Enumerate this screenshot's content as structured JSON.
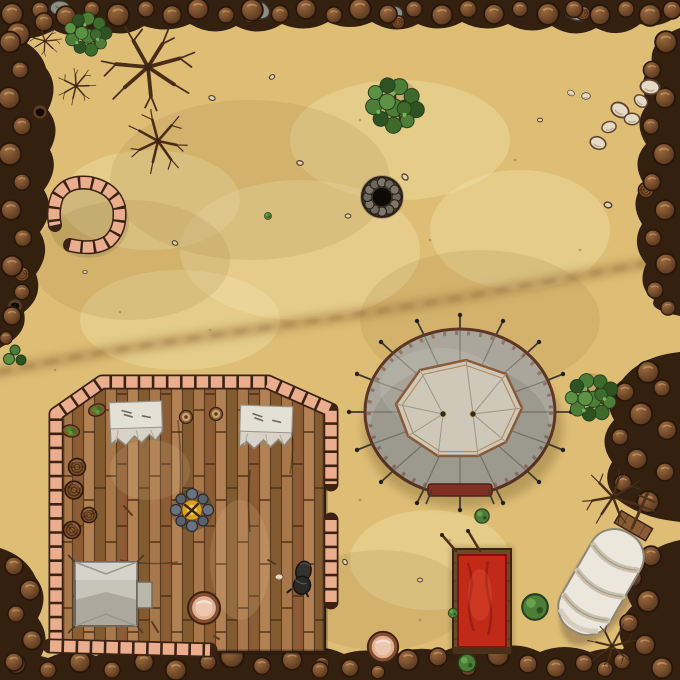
{
  "map": {
    "width": 680,
    "height": 680,
    "scene": "desert camp battle map"
  },
  "colors": {
    "sand": "#debe75",
    "sand_light": "#efd9a0",
    "sand_dark": "#c4a05c",
    "trail": "#a8824a",
    "rock_dark": "#33200f",
    "rock_mid": "#6e452a",
    "rock_light": "#936744",
    "brick": "#eaae8e",
    "brick_dark": "#3c2212",
    "wood": "#9a6c42",
    "wood_dark": "#5a3a1e",
    "canvas": "#aaa69b",
    "canvas_light": "#cdc8b7",
    "trim_brown": "#5e3626",
    "red": "#c22a18",
    "red_dark": "#7e150c",
    "leaf": "#4d7d37",
    "leaf_dark": "#2e5222",
    "branch": "#4a2d17",
    "fire": "#d9a31f",
    "stone_blue": "#656d78",
    "pot": "#e0b193",
    "pot_dark": "#8a5030",
    "white_stone": "#e6dac4",
    "well_dark": "#0d0a07"
  },
  "objects": {
    "trail": {
      "d": "M0,372 C110,348 240,332 352,315 C450,301 560,279 648,263"
    },
    "stone_pen": {
      "transform": "translate(87,216)"
    },
    "well": {
      "transform": "translate(382,197)"
    },
    "building": {
      "transform": "translate(0,0)"
    },
    "camp_fire": {
      "transform": "translate(192,510)"
    },
    "small_tent": {
      "transform": "translate(106,594)"
    },
    "table_1": {
      "transform": "translate(136,422) rotate(-2)"
    },
    "table_2": {
      "transform": "translate(266,426) rotate(2)"
    },
    "black_bag": {
      "transform": "translate(302,577) rotate(14)"
    },
    "pavilion": {
      "transform": "translate(460,412)"
    },
    "red_tent": {
      "transform": "translate(482,601)"
    },
    "wagon": {
      "transform": "translate(601,582) rotate(30)"
    }
  },
  "terrain_instances": [
    [
      "rock-gray",
      "gray-slab",
      258,
      10,
      1.1,
      20
    ],
    [
      "rock-gray",
      "gray-slab",
      392,
      14,
      1.0,
      -10
    ],
    [
      "rock-gray",
      "gray-slab",
      577,
      12,
      1.1,
      15
    ],
    [
      "rock-gray",
      "gray-slab",
      60,
      8,
      0.9,
      0
    ],
    [
      "barrel",
      "rock-barrel",
      250,
      16,
      0.8
    ],
    [
      "barrel",
      "rock-barrel",
      398,
      22,
      0.75
    ],
    [
      "barrel",
      "rock-barrel",
      118,
      9,
      0.7
    ],
    [
      "barrel",
      "rock-barrel",
      583,
      13,
      0.8
    ],
    [
      "barrel",
      "rock-barrel",
      646,
      190,
      0.9
    ],
    [
      "barrel",
      "rock-barrel",
      652,
      560,
      0.8
    ],
    [
      "barrel",
      "rock-barrel",
      322,
      664,
      0.8
    ],
    [
      "barrel",
      "rock-barrel",
      22,
      274,
      0.85
    ],
    [
      "dark-hole",
      "rock-hole",
      40,
      112,
      1
    ],
    [
      "dark-hole",
      "rock-hole",
      15,
      306,
      1
    ],
    [
      "boulder-brown",
      "rock-boulder",
      12,
      14,
      1.2
    ],
    [
      "boulder-brown",
      "rock-boulder",
      40,
      10,
      0.9
    ],
    [
      "boulder-brown",
      "rock-boulder",
      66,
      16,
      1.1
    ],
    [
      "boulder-brown",
      "rock-boulder",
      92,
      9,
      0.85
    ],
    [
      "boulder-brown",
      "rock-boulder",
      118,
      15,
      1.25
    ],
    [
      "boulder-brown",
      "rock-boulder",
      146,
      9,
      0.9
    ],
    [
      "boulder-brown",
      "rock-boulder",
      172,
      15,
      1.05
    ],
    [
      "boulder-brown",
      "rock-boulder",
      198,
      9,
      1.15
    ],
    [
      "boulder-brown",
      "rock-boulder",
      226,
      15,
      0.9
    ],
    [
      "boulder-brown",
      "rock-boulder",
      252,
      10,
      1.2
    ],
    [
      "boulder-brown",
      "rock-boulder",
      280,
      14,
      0.95
    ],
    [
      "boulder-brown",
      "rock-boulder",
      306,
      9,
      1.1
    ],
    [
      "boulder-brown",
      "rock-boulder",
      334,
      15,
      0.9
    ],
    [
      "boulder-brown",
      "rock-boulder",
      360,
      9,
      1.2
    ],
    [
      "boulder-brown",
      "rock-boulder",
      388,
      14,
      1.0
    ],
    [
      "boulder-brown",
      "rock-boulder",
      414,
      9,
      0.9
    ],
    [
      "boulder-brown",
      "rock-boulder",
      442,
      15,
      1.15
    ],
    [
      "boulder-brown",
      "rock-boulder",
      468,
      9,
      0.95
    ],
    [
      "boulder-brown",
      "rock-boulder",
      494,
      14,
      1.1
    ],
    [
      "boulder-brown",
      "rock-boulder",
      520,
      9,
      0.85
    ],
    [
      "boulder-brown",
      "rock-boulder",
      548,
      14,
      1.2
    ],
    [
      "boulder-brown",
      "rock-boulder",
      574,
      9,
      0.95
    ],
    [
      "boulder-brown",
      "rock-boulder",
      600,
      15,
      1.1
    ],
    [
      "boulder-brown",
      "rock-boulder",
      626,
      9,
      0.9
    ],
    [
      "boulder-brown",
      "rock-boulder",
      650,
      15,
      1.2
    ],
    [
      "boulder-brown",
      "rock-boulder",
      672,
      10,
      1.0
    ],
    [
      "boulder-brown",
      "rock-boulder",
      18,
      34,
      1.3
    ],
    [
      "boulder-brown",
      "rock-boulder",
      44,
      22,
      1.0
    ],
    [
      "boulder-brown",
      "rock-boulder",
      10,
      42,
      1.15
    ],
    [
      "boulder-brown",
      "rock-boulder",
      20,
      70,
      0.9
    ],
    [
      "boulder-brown",
      "rock-boulder",
      9,
      98,
      1.2
    ],
    [
      "boulder-brown",
      "rock-boulder",
      22,
      126,
      1.0
    ],
    [
      "boulder-brown",
      "rock-boulder",
      10,
      154,
      1.25
    ],
    [
      "boulder-brown",
      "rock-boulder",
      22,
      182,
      0.9
    ],
    [
      "boulder-brown",
      "rock-boulder",
      11,
      210,
      1.1
    ],
    [
      "boulder-brown",
      "rock-boulder",
      23,
      238,
      0.95
    ],
    [
      "boulder-brown",
      "rock-boulder",
      12,
      266,
      1.15
    ],
    [
      "boulder-brown",
      "rock-boulder",
      22,
      292,
      0.85
    ],
    [
      "boulder-brown",
      "rock-boulder",
      12,
      316,
      1.0
    ],
    [
      "boulder-brown",
      "rock-boulder",
      6,
      338,
      0.7
    ],
    [
      "boulder-brown",
      "rock-boulder",
      666,
      42,
      1.2
    ],
    [
      "boulder-brown",
      "rock-boulder",
      652,
      70,
      0.95
    ],
    [
      "boulder-brown",
      "rock-boulder",
      665,
      98,
      1.1
    ],
    [
      "boulder-brown",
      "rock-boulder",
      651,
      126,
      0.9
    ],
    [
      "boulder-brown",
      "rock-boulder",
      664,
      154,
      1.2
    ],
    [
      "boulder-brown",
      "rock-boulder",
      652,
      182,
      0.95
    ],
    [
      "boulder-brown",
      "rock-boulder",
      665,
      210,
      1.1
    ],
    [
      "boulder-brown",
      "rock-boulder",
      653,
      238,
      0.9
    ],
    [
      "boulder-brown",
      "rock-boulder",
      666,
      264,
      1.15
    ],
    [
      "boulder-brown",
      "rock-boulder",
      655,
      290,
      0.9
    ],
    [
      "boulder-brown",
      "rock-boulder",
      668,
      308,
      0.8
    ],
    [
      "boulder-brown",
      "rock-boulder",
      648,
      372,
      1.2
    ],
    [
      "boulder-brown",
      "rock-boulder",
      625,
      392,
      1.0
    ],
    [
      "boulder-brown",
      "rock-boulder",
      641,
      414,
      1.25
    ],
    [
      "boulder-brown",
      "rock-boulder",
      620,
      437,
      0.9
    ],
    [
      "boulder-brown",
      "rock-boulder",
      637,
      459,
      1.1
    ],
    [
      "boulder-brown",
      "rock-boulder",
      623,
      483,
      0.95
    ],
    [
      "boulder-brown",
      "rock-boulder",
      648,
      502,
      1.2
    ],
    [
      "boulder-brown",
      "rock-boulder",
      667,
      430,
      1.05
    ],
    [
      "boulder-brown",
      "rock-boulder",
      662,
      388,
      0.9
    ],
    [
      "boulder-brown",
      "rock-boulder",
      665,
      472,
      1.0
    ],
    [
      "boulder-brown",
      "rock-boulder",
      651,
      556,
      1.1
    ],
    [
      "boulder-brown",
      "rock-boulder",
      633,
      578,
      0.95
    ],
    [
      "boulder-brown",
      "rock-boulder",
      648,
      601,
      1.2
    ],
    [
      "boulder-brown",
      "rock-boulder",
      629,
      623,
      1.0
    ],
    [
      "boulder-brown",
      "rock-boulder",
      645,
      645,
      1.1
    ],
    [
      "boulder-brown",
      "rock-boulder",
      622,
      661,
      0.9
    ],
    [
      "boulder-brown",
      "rock-boulder",
      662,
      668,
      1.15
    ],
    [
      "boulder-brown",
      "rock-boulder",
      605,
      669,
      0.85
    ],
    [
      "boulder-brown",
      "rock-boulder",
      16,
      664,
      1.05
    ],
    [
      "boulder-brown",
      "rock-boulder",
      48,
      670,
      0.9
    ],
    [
      "boulder-brown",
      "rock-boulder",
      80,
      662,
      1.15
    ],
    [
      "boulder-brown",
      "rock-boulder",
      112,
      670,
      0.9
    ],
    [
      "boulder-brown",
      "rock-boulder",
      144,
      662,
      1.05
    ],
    [
      "boulder-brown",
      "rock-boulder",
      176,
      670,
      1.15
    ],
    [
      "boulder-brown",
      "rock-boulder",
      208,
      662,
      0.9
    ],
    [
      "boulder-brown",
      "rock-boulder",
      232,
      656,
      1.3
    ],
    [
      "boulder-brown",
      "rock-boulder",
      262,
      666,
      0.95
    ],
    [
      "boulder-brown",
      "rock-boulder",
      292,
      660,
      1.1
    ],
    [
      "boulder-brown",
      "rock-boulder",
      320,
      670,
      0.9
    ],
    [
      "boulder-brown",
      "rock-boulder",
      350,
      668,
      0.95
    ],
    [
      "boulder-brown",
      "rock-boulder",
      378,
      672,
      0.75
    ],
    [
      "boulder-brown",
      "rock-boulder",
      408,
      660,
      1.15
    ],
    [
      "boulder-brown",
      "rock-boulder",
      438,
      657,
      1.0
    ],
    [
      "boulder-brown",
      "rock-boulder",
      468,
      668,
      0.85
    ],
    [
      "boulder-brown",
      "rock-boulder",
      498,
      655,
      1.2
    ],
    [
      "boulder-brown",
      "rock-boulder",
      528,
      664,
      1.0
    ],
    [
      "boulder-brown",
      "rock-boulder",
      556,
      668,
      1.05
    ],
    [
      "boulder-brown",
      "rock-boulder",
      584,
      663,
      0.95
    ],
    [
      "boulder-brown",
      "rock-boulder",
      14,
      566,
      1.0
    ],
    [
      "boulder-brown",
      "rock-boulder",
      30,
      590,
      1.1
    ],
    [
      "boulder-brown",
      "rock-boulder",
      16,
      614,
      0.9
    ],
    [
      "boulder-brown",
      "rock-boulder",
      32,
      640,
      1.05
    ],
    [
      "boulder-brown",
      "rock-boulder",
      14,
      662,
      1.0
    ]
  ],
  "object_instances": [
    [
      "tree-green",
      "green-tree",
      88,
      33,
      0.8,
      0,
      true
    ],
    [
      "tree-green",
      "green-tree",
      395,
      104,
      1.0,
      15,
      true
    ],
    [
      "tree-green",
      "green-tree",
      592,
      396,
      0.9,
      -20,
      true
    ],
    [
      "scrub-tree",
      "dead-scrub",
      45,
      41,
      0.5,
      10,
      true
    ],
    [
      "scrub-tree",
      "dead-scrub",
      76,
      86,
      0.6,
      -35,
      true
    ],
    [
      "scrub-tree",
      "dead-scrub",
      148,
      67,
      1.45,
      0,
      true
    ],
    [
      "scrub-tree",
      "dead-scrub",
      158,
      141,
      1.0,
      70,
      true
    ],
    [
      "scrub-tree",
      "dead-scrub",
      613,
      497,
      0.95,
      -15,
      true
    ],
    [
      "scrub-tree",
      "dead-scrub",
      612,
      646,
      0.75,
      160,
      true
    ],
    [
      "ball-bush",
      "small-bush",
      482,
      516,
      0.9,
      0,
      true
    ],
    [
      "ball-bush",
      "small-bush",
      453,
      613,
      0.6,
      0,
      true
    ],
    [
      "ball-bush",
      "small-bush",
      467,
      663,
      1.1,
      0,
      true
    ],
    [
      "ball-bush",
      "small-weed",
      268,
      216,
      0.45,
      0,
      false
    ],
    [
      "cactus",
      "cactus",
      15,
      356,
      1,
      0,
      true
    ],
    [
      "ball-bush",
      "bush-tree",
      535,
      607,
      1.6,
      0,
      true
    ],
    [
      "boulder-white",
      "white-boulder",
      598,
      143,
      1.0,
      20
    ],
    [
      "boulder-white",
      "white-boulder",
      609,
      127,
      0.9,
      -15
    ],
    [
      "boulder-white",
      "white-boulder",
      620,
      110,
      1.15,
      30
    ],
    [
      "boulder-white",
      "white-boulder",
      632,
      119,
      0.95,
      0
    ],
    [
      "boulder-white",
      "white-boulder",
      641,
      101,
      0.9,
      40
    ],
    [
      "boulder-white",
      "white-boulder",
      650,
      87,
      1.2,
      10
    ],
    [
      "boulder-white",
      "white-boulder",
      586,
      96,
      0.55,
      0
    ],
    [
      "boulder-white",
      "white-boulder",
      571,
      93,
      0.45,
      25
    ],
    [
      "boulder-white",
      "white-stone",
      279,
      577,
      0.5,
      0
    ],
    [
      "pebble",
      "pebble",
      212,
      98,
      1,
      20
    ],
    [
      "pebble",
      "pebble",
      272,
      77,
      0.9,
      -30
    ],
    [
      "pebble",
      "pebble",
      300,
      163,
      1,
      10
    ],
    [
      "pebble",
      "pebble",
      405,
      177,
      1.1,
      45
    ],
    [
      "pebble",
      "pebble",
      348,
      216,
      0.9,
      0
    ],
    [
      "pebble",
      "pebble",
      608,
      205,
      1.2,
      15
    ],
    [
      "pebble",
      "pebble",
      420,
      580,
      0.8,
      0
    ],
    [
      "pebble",
      "pebble",
      175,
      243,
      0.9,
      30
    ],
    [
      "pebble",
      "pebble",
      540,
      120,
      0.8,
      0
    ],
    [
      "pebble",
      "pebble",
      345,
      562,
      0.9,
      60
    ],
    [
      "pebble",
      "pebble",
      85,
      272,
      0.7,
      0
    ],
    [
      "barrel",
      "barrel",
      77,
      467,
      1.0,
      0,
      true
    ],
    [
      "barrel",
      "barrel",
      74,
      490,
      1.05,
      30,
      true
    ],
    [
      "barrel",
      "barrel",
      89,
      515,
      0.9,
      -20,
      true
    ],
    [
      "barrel",
      "barrel",
      72,
      530,
      1.0,
      45,
      true
    ],
    [
      "bowl",
      "bowl",
      186,
      417,
      1,
      0,
      true
    ],
    [
      "bowl",
      "bowl",
      216,
      414,
      1,
      0,
      true
    ],
    [
      "basket-green",
      "vegetable-basket",
      97,
      410,
      1,
      -15,
      true
    ],
    [
      "basket-green",
      "vegetable-basket",
      71,
      431,
      1,
      10,
      true
    ],
    [
      "pot-clay",
      "clay-pot",
      204,
      608,
      1.0,
      0,
      true
    ],
    [
      "pot-clay",
      "clay-pot",
      383,
      647,
      0.95,
      0,
      true
    ]
  ]
}
